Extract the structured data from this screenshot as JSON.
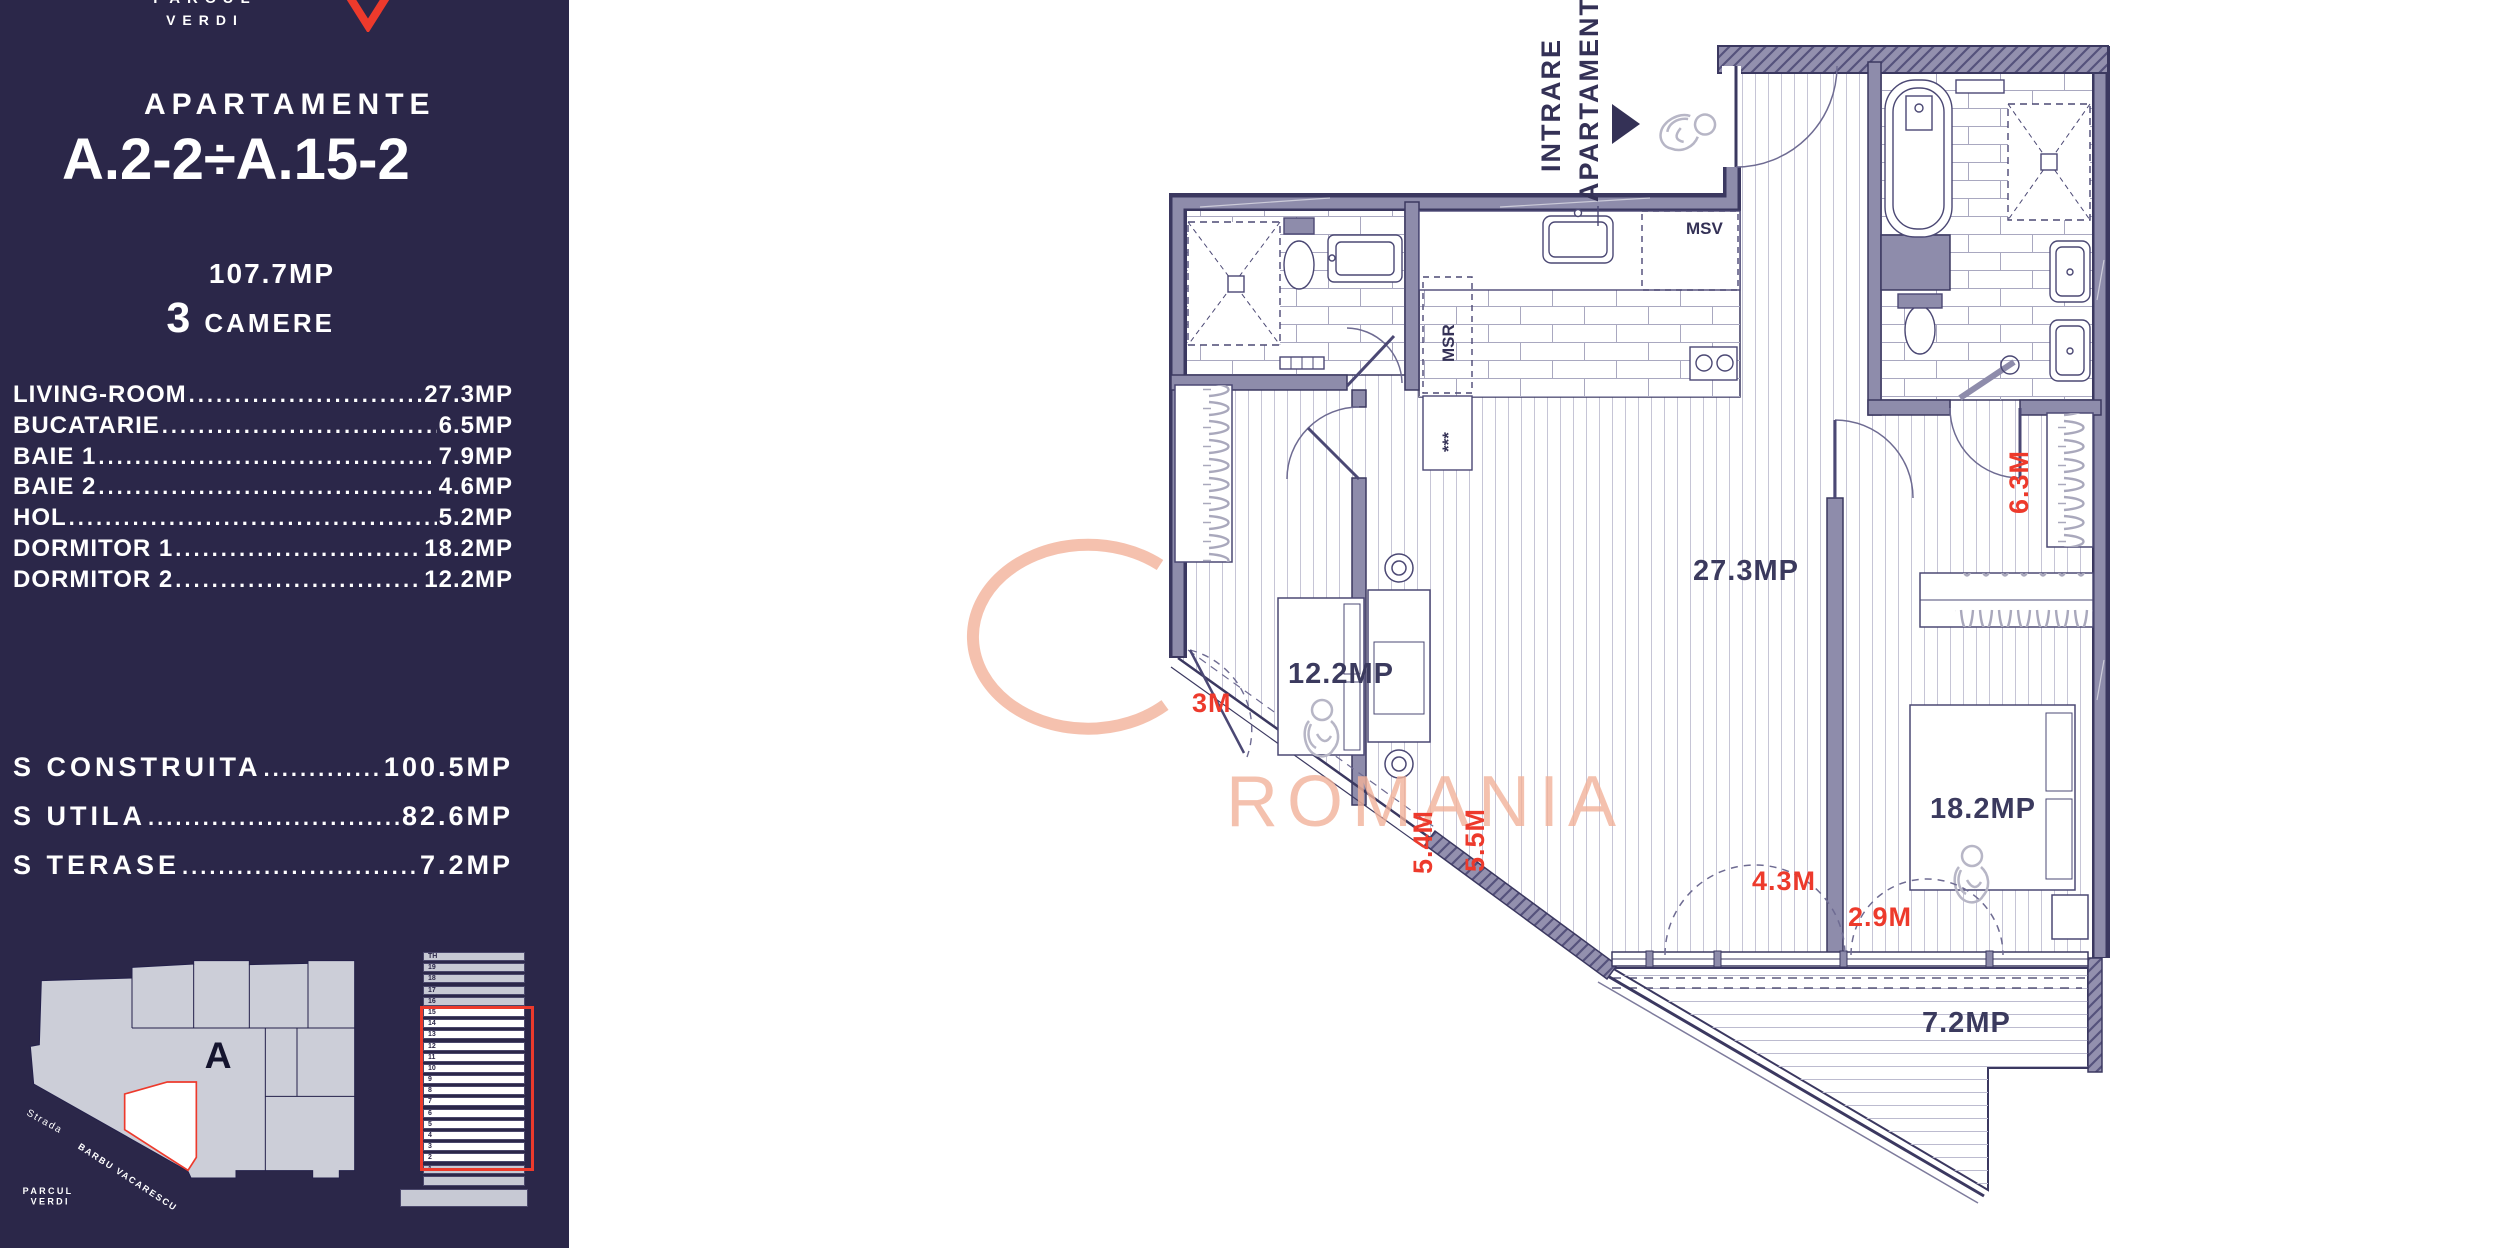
{
  "colors": {
    "navy": "#2b2749",
    "red": "#ed3a2c",
    "wall": "#8e8cab",
    "salmon": "#f2b29a"
  },
  "sidebar": {
    "logo": {
      "word_top": "PARCUL",
      "word_bottom": "VERDI"
    },
    "header": {
      "label": "APARTAMENTE",
      "title": "A.2-2÷A.15-2",
      "total_area": "107.7MP",
      "rooms_count": "3",
      "rooms_label": "CAMERE"
    },
    "leader": ".................................................",
    "room_list": [
      {
        "name": "LIVING-ROOM",
        "value": "27.3MP"
      },
      {
        "name": "BUCATARIE",
        "value": "6.5MP"
      },
      {
        "name": "BAIE 1",
        "value": "7.9MP"
      },
      {
        "name": "BAIE 2",
        "value": "4.6MP"
      },
      {
        "name": "HOL",
        "value": "5.2MP"
      },
      {
        "name": "DORMITOR 1",
        "value": "18.2MP"
      },
      {
        "name": "DORMITOR 2",
        "value": "12.2MP"
      }
    ],
    "totals": [
      {
        "name": "S CONSTRUITA",
        "value": "100.5MP"
      },
      {
        "name": "S UTILA",
        "value": "82.6MP"
      },
      {
        "name": "S TERASE",
        "value": "7.2MP"
      }
    ],
    "site_plan": {
      "block_label": "A",
      "street_prefix": "Strada",
      "street_name": "BARBU VACARESCU",
      "park_line1": "PARCUL",
      "park_line2": "VERDI"
    },
    "elevation": {
      "floors": [
        "TH",
        "19",
        "18",
        "17",
        "16",
        "15",
        "14",
        "13",
        "12",
        "11",
        "10",
        "9",
        "8",
        "7",
        "6",
        "5",
        "4",
        "3",
        "2",
        "1"
      ],
      "highlight_start_index": 5,
      "highlight_end_index": 18
    }
  },
  "plan": {
    "entrance": {
      "line1": "INTRARE",
      "line2": "APARTAMENT"
    },
    "areas": {
      "living": "27.3MP",
      "dormitor2": "12.2MP",
      "dormitor1": "18.2MP",
      "terrace": "7.2MP"
    },
    "dimensions": {
      "d3m": "3M",
      "d54": "5.4M",
      "d55": "5.5M",
      "d43": "4.3M",
      "d29": "2.9M",
      "d63": "6.3M"
    },
    "annotations": {
      "msv": "MSV",
      "msr": "MSR",
      "stars": "***"
    },
    "watermark": "ROMANIA"
  }
}
